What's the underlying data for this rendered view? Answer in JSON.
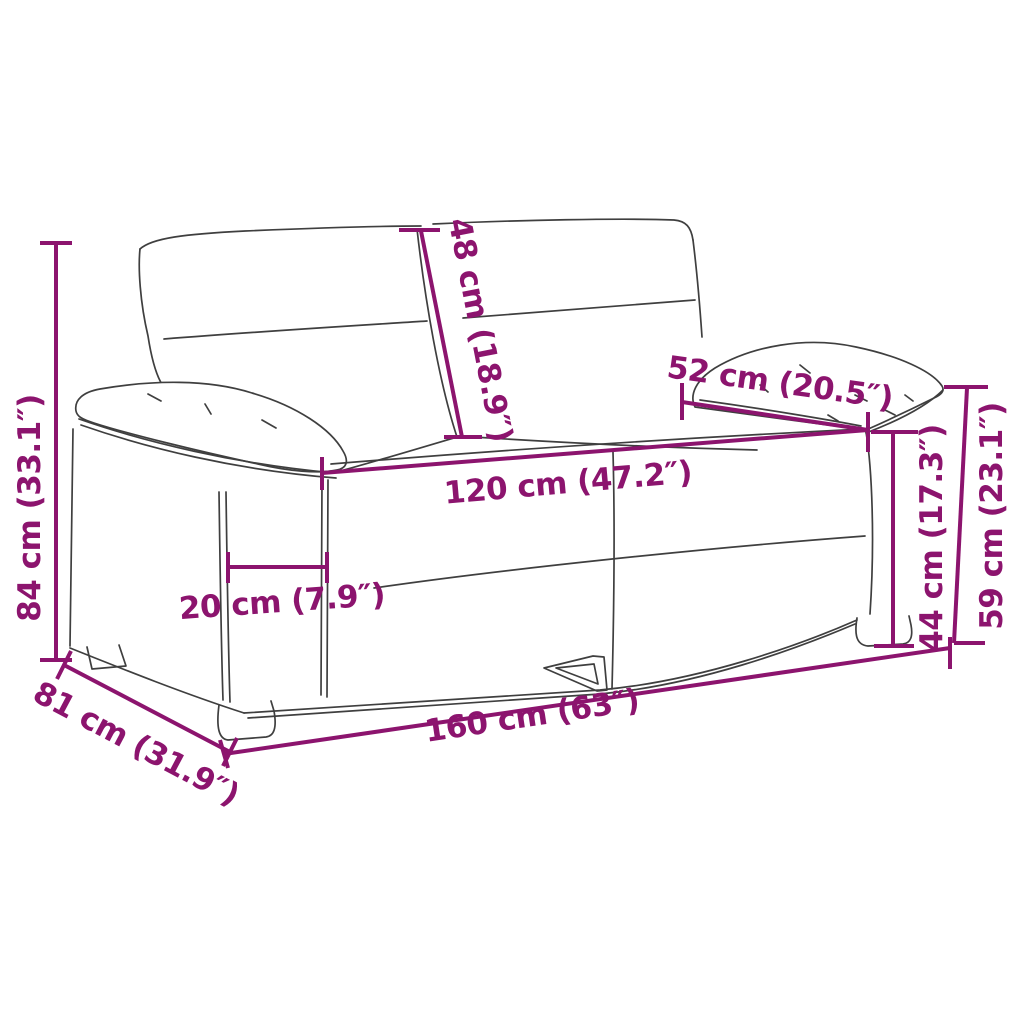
{
  "style": {
    "dimension_color": "#8C146E",
    "outline_color": "#3f3f3f",
    "background_color": "#ffffff"
  },
  "diagram": {
    "subject": "two-seater-sofa-line-art"
  },
  "dimensions": {
    "total_height": "84 cm (33.1″)",
    "backrest_height": "48 cm (18.9″)",
    "armrest_depth": "52 cm (20.5″)",
    "seat_width": "120 cm (47.2″)",
    "armrest_width": "20 cm (7.9″)",
    "seat_height": "44 cm (17.3″)",
    "arm_height": "59 cm (23.1″)",
    "total_width": "160 cm (63″)",
    "total_depth": "81 cm (31.9″)"
  }
}
